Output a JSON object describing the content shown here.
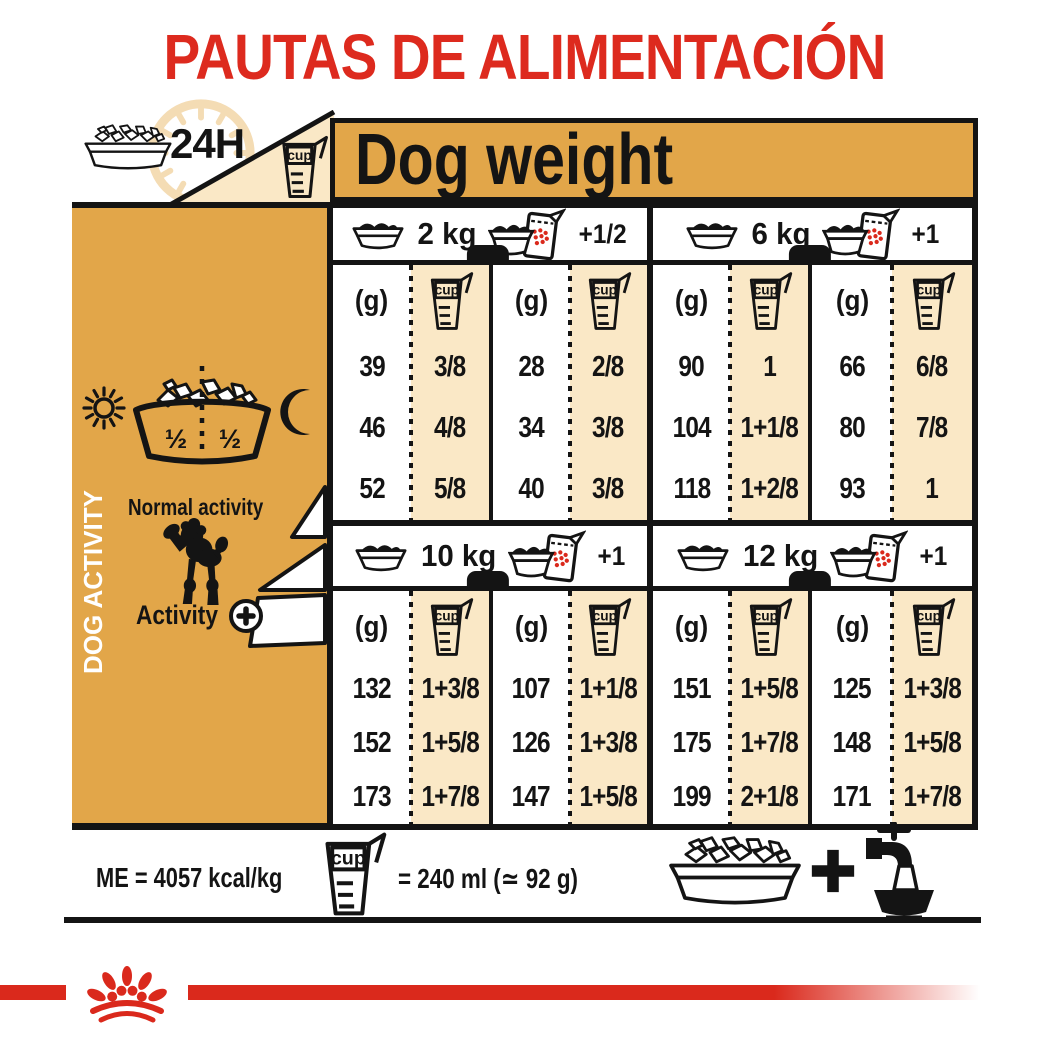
{
  "title": "PAUTAS DE ALIMENTACIÓN",
  "header": {
    "duration": "24H",
    "dog_weight": "Dog weight"
  },
  "labels": {
    "cup": "cup",
    "grams": "(g)"
  },
  "sidebar": {
    "half_left": "½",
    "half_right": "½",
    "dog_activity": "DOG ACTIVITY",
    "normal_activity": "Normal activity",
    "activity": "Activity",
    "activity_plus": "+"
  },
  "sections": [
    {
      "weight": "2 kg",
      "surplus": "+1/2",
      "pairs": [
        {
          "rows": [
            {
              "g": "39",
              "cup": "3/8"
            },
            {
              "g": "46",
              "cup": "4/8"
            },
            {
              "g": "52",
              "cup": "5/8"
            }
          ]
        },
        {
          "rows": [
            {
              "g": "28",
              "cup": "2/8"
            },
            {
              "g": "34",
              "cup": "3/8"
            },
            {
              "g": "40",
              "cup": "3/8"
            }
          ]
        }
      ]
    },
    {
      "weight": "6 kg",
      "surplus": "+1",
      "pairs": [
        {
          "rows": [
            {
              "g": "90",
              "cup": "1"
            },
            {
              "g": "104",
              "cup": "1+1/8"
            },
            {
              "g": "118",
              "cup": "1+2/8"
            }
          ]
        },
        {
          "rows": [
            {
              "g": "66",
              "cup": "6/8"
            },
            {
              "g": "80",
              "cup": "7/8"
            },
            {
              "g": "93",
              "cup": "1"
            }
          ]
        }
      ]
    },
    {
      "weight": "10 kg",
      "surplus": "+1",
      "pairs": [
        {
          "rows": [
            {
              "g": "132",
              "cup": "1+3/8"
            },
            {
              "g": "152",
              "cup": "1+5/8"
            },
            {
              "g": "173",
              "cup": "1+7/8"
            }
          ]
        },
        {
          "rows": [
            {
              "g": "107",
              "cup": "1+1/8"
            },
            {
              "g": "126",
              "cup": "1+3/8"
            },
            {
              "g": "147",
              "cup": "1+5/8"
            }
          ]
        }
      ]
    },
    {
      "weight": "12 kg",
      "surplus": "+1",
      "pairs": [
        {
          "rows": [
            {
              "g": "151",
              "cup": "1+5/8"
            },
            {
              "g": "175",
              "cup": "1+7/8"
            },
            {
              "g": "199",
              "cup": "2+1/8"
            }
          ]
        },
        {
          "rows": [
            {
              "g": "125",
              "cup": "1+3/8"
            },
            {
              "g": "148",
              "cup": "1+5/8"
            },
            {
              "g": "171",
              "cup": "1+7/8"
            }
          ]
        }
      ]
    }
  ],
  "footer": {
    "me": "ME = 4057 kcal/kg",
    "cup_equals": "= 240 ml (≃ 92 g)",
    "plus": "+"
  },
  "colors": {
    "gold": "#E2A649",
    "cream": "#FAE8C6",
    "red": "#DD2A1E",
    "black": "#141414"
  }
}
